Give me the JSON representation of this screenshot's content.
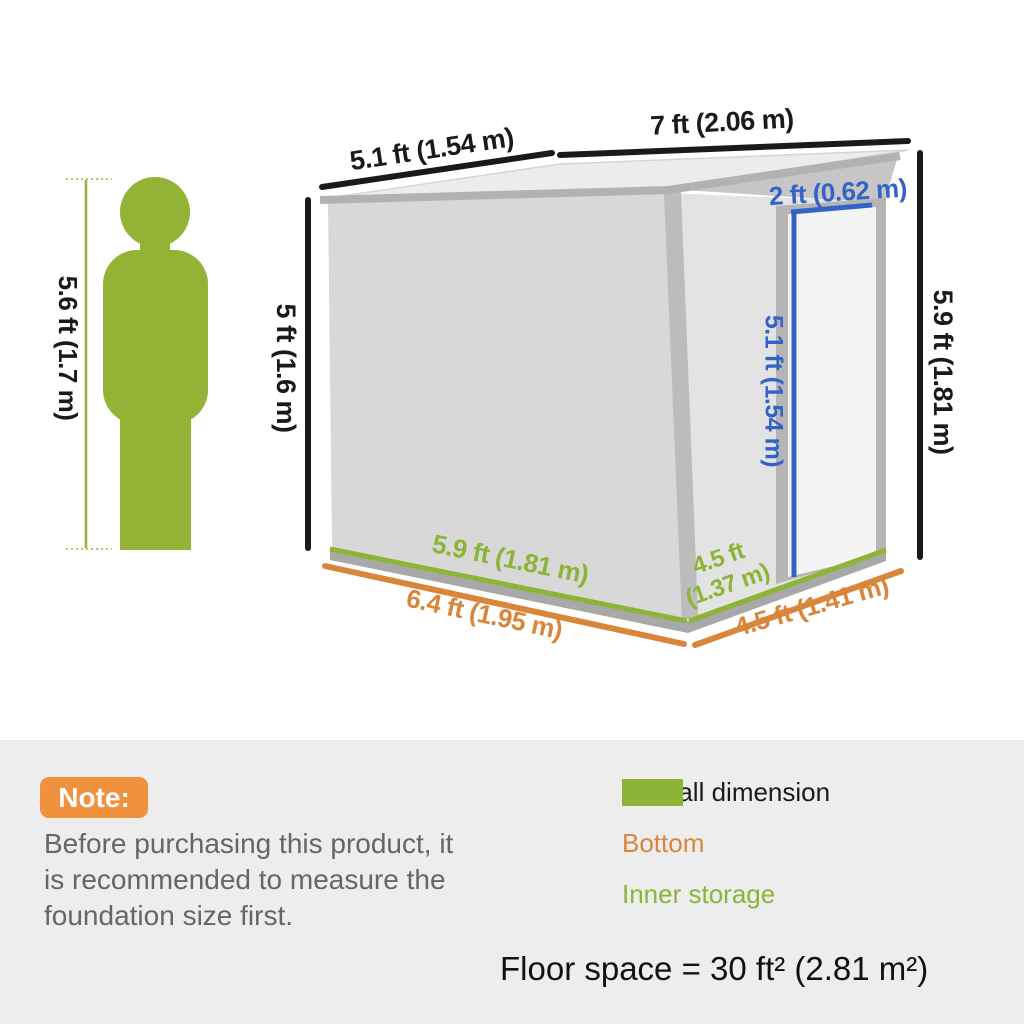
{
  "diagram": {
    "person_height": "5.6 ft (1.7 m)",
    "roof_left_width": "5.1 ft (1.54 m)",
    "roof_right_width": "7 ft (2.06 m)",
    "left_wall_height": "5 ft (1.6 m)",
    "right_wall_height": "5.9 ft (1.81 m)",
    "door_width": "2 ft (0.62 m)",
    "door_height": "5.1 ft (1.54 m)",
    "inner_depth": "5.9 ft (1.81 m)",
    "bottom_depth": "6.4 ft (1.95 m)",
    "inner_width_line1": "4.5 ft",
    "inner_width_line2": "(1.37 m)",
    "bottom_width": "4.5 ft (1.41 m)"
  },
  "note": {
    "badge": "Note:",
    "line1": "Before purchasing this product, it",
    "line2": "is recommended to measure the",
    "line3": "foundation size first."
  },
  "legend": {
    "items": [
      {
        "label": "Overall dimension",
        "color": "#111111"
      },
      {
        "label": "Bottom",
        "color": "#D9863B"
      },
      {
        "label": "Inner storage",
        "color": "#8CB437"
      }
    ]
  },
  "floor_space": "Floor space = 30 ft² (2.81 m²)",
  "colors": {
    "dimension_black": "#1a1a1a",
    "dimension_blue": "#3463C7",
    "dimension_green": "#8CB437",
    "dimension_orange": "#D9863B",
    "person_green": "#92B335",
    "note_badge_orange": "#F0913D",
    "footer_background": "#EDEDED"
  }
}
